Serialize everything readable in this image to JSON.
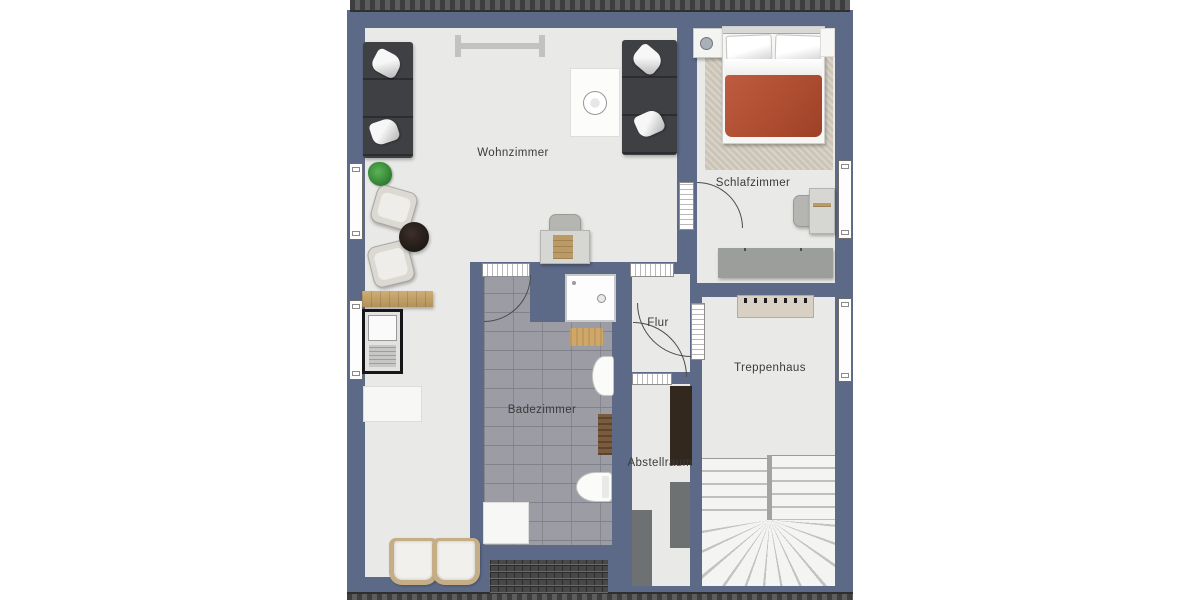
{
  "plan": {
    "title": "floor-plan",
    "rooms": [
      {
        "id": "wohnzimmer",
        "label": "Wohnzimmer"
      },
      {
        "id": "schlafzimmer",
        "label": "Schlafzimmer"
      },
      {
        "id": "flur",
        "label": "Flur"
      },
      {
        "id": "treppenhaus",
        "label": "Treppenhaus"
      },
      {
        "id": "badezimmer",
        "label": "Badezimmer"
      },
      {
        "id": "abstellraum",
        "label": "Abstellraum"
      }
    ]
  },
  "colors": {
    "wall": "#5c6a88",
    "floor": "#e9e9e7",
    "tile": "#9c9ca4",
    "duvet": "#ae4d31",
    "rug": "#ccc5b7",
    "sofa": "#3f4044",
    "wood": "#c2a169"
  }
}
